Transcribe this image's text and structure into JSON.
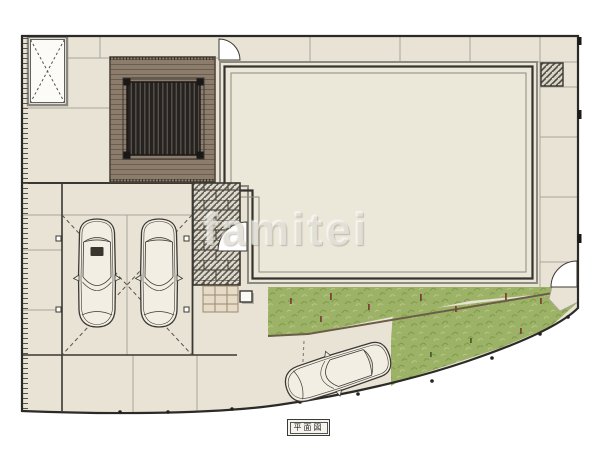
{
  "plan": {
    "label": "平面図",
    "watermark": "famitei"
  },
  "palette": {
    "background": "#ffffff",
    "paving": "#e8e3d5",
    "paving_joint": "#a9a59a",
    "boundary": "#2b2a26",
    "building_fill": "#ebe7d9",
    "wall_dark": "#35332e",
    "outline_gray": "#8d8a80",
    "deck_fill": "#8c7c6c",
    "deck_line": "#6b5d4f",
    "pergola_fill": "#262220",
    "pergola_slat": "#57514b",
    "porch_base": "#dcd8cb",
    "porch_hatch": "#4f4b42",
    "brick_joint": "#33312c",
    "step_fill": "#e6dbc6",
    "step_line": "#9a8a6e",
    "grass_base": "#9cb266",
    "grass_dark": "#7d9c4a",
    "grass_light": "#b7c783",
    "plant_mark_red": "#7c4436",
    "plant_mark_green": "#4e5e2e",
    "car_body": "#f2eee4",
    "car_line": "#3b3833",
    "glass": "#ddd8cb",
    "edging": "#6b5d48",
    "arc_fill": "#ffffff"
  }
}
